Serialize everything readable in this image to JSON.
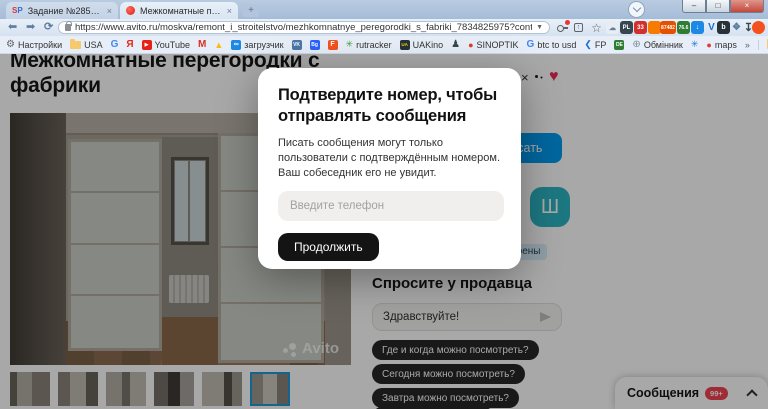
{
  "colors": {
    "avito_blue": "#009cf0",
    "avatar_teal": "#2cb5c4",
    "chip_bg": "#262626",
    "badge_red": "#f2434f",
    "heart_red": "#ee2953",
    "thumb_selected_border": "#1f9ad6",
    "modal_button_bg": "#141414"
  },
  "browser": {
    "tabs": [
      {
        "favicon": "SP",
        "title": "Задание №2851455 - просмотр з",
        "close": "×"
      },
      {
        "favicon": "red-dot",
        "title": "Межкомнатные перегородки с ф",
        "close": "×"
      }
    ],
    "new_tab": "+",
    "controls": {
      "minimize": "–",
      "maximize": "□",
      "close": "×"
    },
    "nav": {
      "back": "⬅",
      "forward": "➡",
      "reload": "⟳"
    },
    "url": "https://www.avito.ru/moskva/remont_i_stroitelstvo/mezhkomnatnye_peregorodki_s_fabriki_7834825975?context=H4sIAA...",
    "omni_caret": "▼",
    "star": "☆",
    "share_arrow": "↑",
    "extensions": [
      {
        "glyph": "☁"
      },
      {
        "glyph": "PL"
      },
      {
        "glyph": "33"
      },
      {
        "glyph": ""
      },
      {
        "glyph": "87482"
      },
      {
        "glyph": "76.6"
      },
      {
        "glyph": "↓"
      },
      {
        "glyph": "V"
      },
      {
        "glyph": "b"
      },
      {
        "glyph": "❖"
      },
      {
        "glyph": "↧"
      },
      {
        "glyph": ""
      },
      {
        "glyph": "◔"
      }
    ],
    "bookmarks": [
      {
        "icon": "⚙",
        "label": "Настройки"
      },
      {
        "icon": "folder",
        "label": "USA"
      },
      {
        "icon": "G",
        "label": ""
      },
      {
        "icon": "Я",
        "label": ""
      },
      {
        "icon": "▶",
        "label": "YouTube"
      },
      {
        "icon": "M",
        "label": ""
      },
      {
        "icon": "▲",
        "label": ""
      },
      {
        "icon": "∞",
        "label": "загрузчик"
      },
      {
        "icon": "vk",
        "label": ""
      },
      {
        "icon": "Bg",
        "label": ""
      },
      {
        "icon": "F",
        "label": ""
      },
      {
        "icon": "✳",
        "label": "rutracker"
      },
      {
        "icon": "UA",
        "label": "UAKino"
      },
      {
        "icon": "♟",
        "label": ""
      },
      {
        "icon": "●",
        "label": "SINOPTIK"
      },
      {
        "icon": "G",
        "label": "btc to usd"
      },
      {
        "icon": "❮",
        "label": "FP"
      },
      {
        "icon": "DE",
        "label": ""
      },
      {
        "icon": "⊕",
        "label": "Обмінник"
      },
      {
        "icon": "✳",
        "label": ""
      },
      {
        "icon": "●",
        "label": "maps"
      },
      {
        "icon": "»",
        "label": ""
      },
      {
        "icon": "folder",
        "label": "Другие закладки"
      }
    ]
  },
  "page": {
    "heading": "Межкомнатные перегородки с фабрики",
    "watermark": "Avito",
    "write_button": "Написать",
    "seller_initial": "Ш",
    "docs_badge": "Документы проверены",
    "heart": "♥"
  },
  "ask": {
    "title": "Спросите у продавца",
    "input_value": "Здравствуйте!",
    "chips": [
      "Где и когда можно посмотреть?",
      "Сегодня можно посмотреть?",
      "Завтра можно посмотреть?",
      ""
    ]
  },
  "messenger": {
    "title": "Сообщения",
    "badge": "99+"
  },
  "modal": {
    "title": "Подтвердите номер, чтобы отправлять сообщения",
    "body": "Писать сообщения могут только пользователи с подтверждённым номером. Ваш собеседник его не увидит.",
    "input_placeholder": "Введите телефон",
    "button": "Продолжить",
    "close": "×"
  }
}
